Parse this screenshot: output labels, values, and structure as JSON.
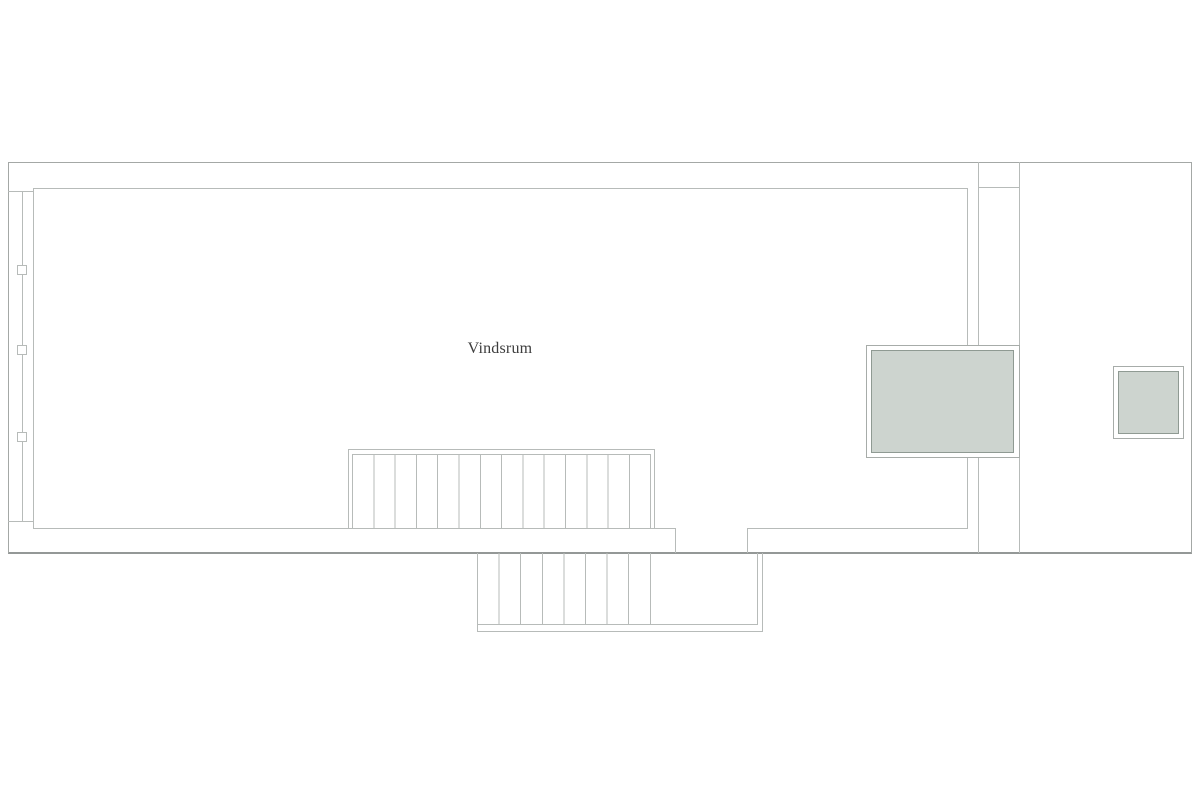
{
  "floorplan": {
    "room": {
      "label": "Vindsrum"
    },
    "colors": {
      "background": "#ffffff",
      "wall_line": "#b7bbb9",
      "outer_wall_line": "#a4a8a6",
      "outer_wall_dark": "#949897",
      "skylight_fill": "#cdd4cf",
      "skylight_border": "#8f9a93",
      "skylight_outer_border": "#a7aca9",
      "label_text": "#3d3d3d"
    },
    "features": {
      "left_wall_window_count": 3,
      "upper_stair_tread_count": 14,
      "lower_stair_tread_count": 8,
      "skylight_count": 2
    }
  }
}
